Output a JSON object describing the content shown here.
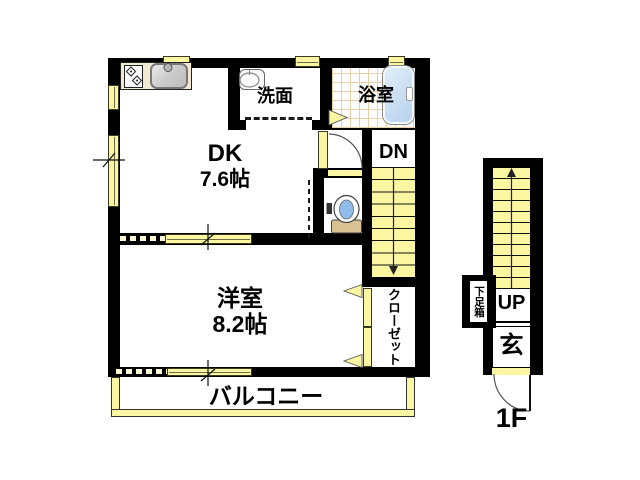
{
  "floor2": {
    "dk": {
      "line1": "DK",
      "line2": "7.6帖"
    },
    "washroom_label": "洗面",
    "bathroom_label": "浴室",
    "stairs_down_label": "DN",
    "western_room": {
      "line1": "洋室",
      "line2": "8.2帖"
    },
    "closet_label": "クローゼット",
    "balcony_label": "バルコニー"
  },
  "floor1": {
    "stairs_up_label": "UP",
    "entrance_label": "玄",
    "shoe_cabinet_label": "下足箱",
    "floor_label": "1F"
  },
  "colors": {
    "wall": "#000000",
    "fixture_yellow": "#FBF6A2",
    "bathtub_blue": "#C9DEF2",
    "tile_line": "#EACFA8",
    "counter_cream": "#F1EAD3",
    "toilet_tank_tan": "#D9C193",
    "toilet_water_blue": "#8FBCE8"
  }
}
